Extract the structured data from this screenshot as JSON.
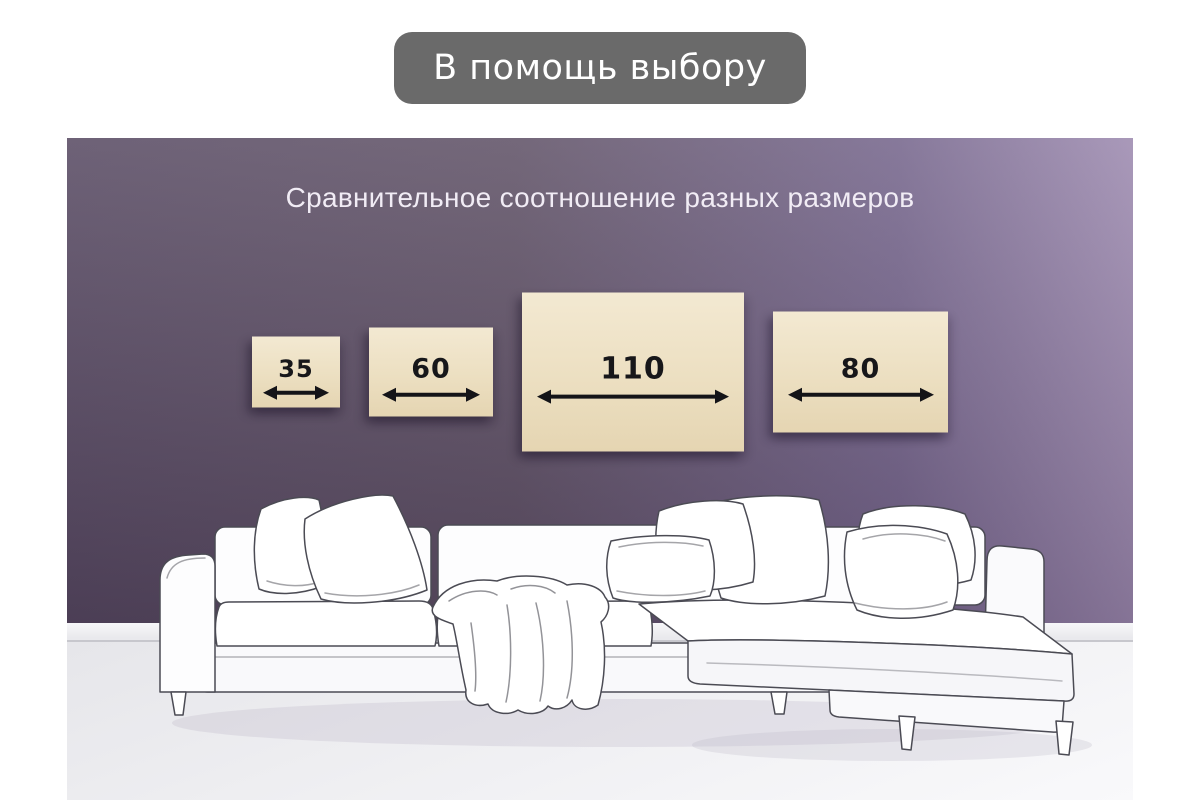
{
  "banner": {
    "label": "В помощь выбору"
  },
  "scene": {
    "title": "Сравнительное соотношение разных размеров",
    "size_cards": [
      {
        "value": "35"
      },
      {
        "value": "60"
      },
      {
        "value": "110"
      },
      {
        "value": "80"
      }
    ]
  },
  "icons": {
    "width_arrow": "double-headed-horizontal-arrow"
  },
  "colors": {
    "banner_bg": "#6a6a6a",
    "banner_text": "#ffffff",
    "wall_dark": "#564861",
    "wall_light": "#9b88ae",
    "card_bg": "#ecdfc1",
    "card_text": "#17171a",
    "title_text": "#f1ecf5",
    "baseboard": "#efeff2",
    "floor": "#efeff2",
    "sofa_outline": "#4b4b54"
  }
}
